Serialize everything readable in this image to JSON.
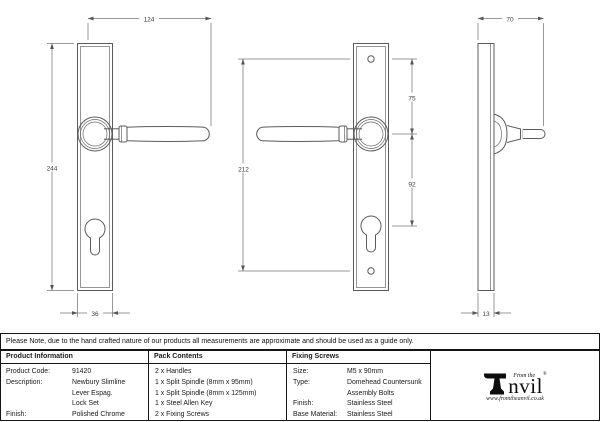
{
  "note": "Please Note, due to the hand crafted nature of our products all measurements are approximate and should be used as a guide only.",
  "drawing": {
    "front_view": {
      "width_dim": "124",
      "height_dim": "244",
      "plate_width_dim": "36"
    },
    "back_view": {
      "fixing_centres_dim": "212",
      "top_screw_to_handle_dim": "75",
      "handle_to_cylinder_dim": "92"
    },
    "side_view": {
      "projection_dim": "70",
      "plate_thickness_dim": "13"
    }
  },
  "table": {
    "product_information": {
      "header": "Product Information",
      "rows": [
        {
          "label": "Product Code:",
          "value": "91420"
        },
        {
          "label": "Description:",
          "value": "Newbury Slimline Lever Espag.",
          "value2": "Lock Set"
        },
        {
          "label": "Finish:",
          "value": "Polished Chrome"
        },
        {
          "label": "Base Material:",
          "value": "Brass"
        }
      ]
    },
    "pack_contents": {
      "header": "Pack Contents",
      "items": [
        "2 x Handles",
        "1 x Split Spindle (8mm x 95mm)",
        "1 x Split Spindle (8mm x 125mm)",
        "1 x Steel Allen Key",
        "2 x Fixing Screws"
      ]
    },
    "fixing_screws": {
      "header": "Fixing Screws",
      "rows": [
        {
          "label": "Size:",
          "value": "M5 x 90mm"
        },
        {
          "label": "Type:",
          "value": "Domehead Countersunk",
          "value2": "Assembly Bolts"
        },
        {
          "label": "Finish:",
          "value": "Stainless Steel"
        },
        {
          "label": "Base Material:",
          "value": "Stainless Steel"
        }
      ]
    },
    "logo": {
      "tagline": "From the",
      "brand_rest": "nvil",
      "reg": "®",
      "website": "www.fromtheanvil.co.uk"
    }
  },
  "colors": {
    "background": "#ffffff",
    "drawing_line": "#5b5b5b",
    "table_border": "#151515",
    "text": "#1a1a1a"
  }
}
